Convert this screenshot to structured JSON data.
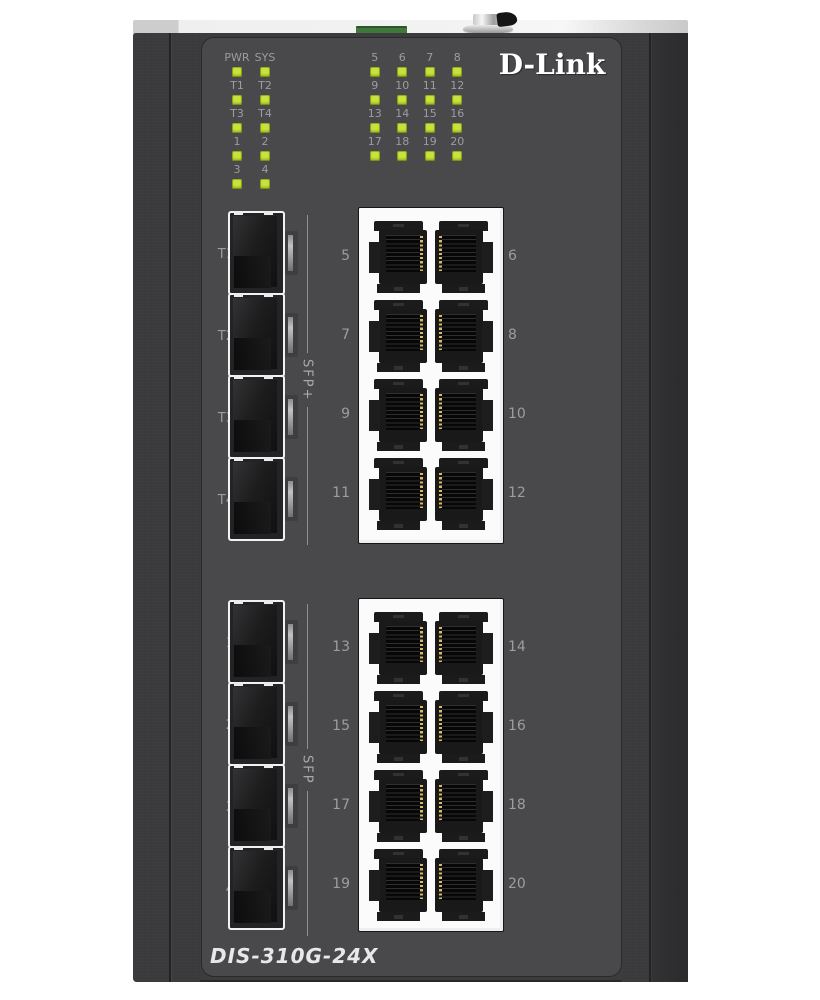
{
  "device": {
    "brand": "D-Link",
    "model": "DIS-310G-24X",
    "led_color": "#c8e23a",
    "body_color": "#49494b"
  },
  "leds": {
    "left": {
      "rows": [
        [
          "PWR",
          "SYS"
        ],
        [
          "T1",
          "T2"
        ],
        [
          "T3",
          "T4"
        ],
        [
          "1",
          "2"
        ],
        [
          "3",
          "4"
        ]
      ]
    },
    "right": {
      "rows": [
        [
          "5",
          "6",
          "7",
          "8"
        ],
        [
          "9",
          "10",
          "11",
          "12"
        ],
        [
          "13",
          "14",
          "15",
          "16"
        ],
        [
          "17",
          "18",
          "19",
          "20"
        ]
      ]
    }
  },
  "upper": {
    "sfp": {
      "labels": [
        "T1",
        "T2",
        "T3",
        "T4"
      ],
      "group": "SFP+"
    },
    "rj45": {
      "left": [
        "5",
        "7",
        "9",
        "11"
      ],
      "right": [
        "6",
        "8",
        "10",
        "12"
      ]
    }
  },
  "lower": {
    "sfp": {
      "labels": [
        "1",
        "2",
        "3",
        "4"
      ],
      "group": "SFP"
    },
    "rj45": {
      "left": [
        "13",
        "15",
        "17",
        "19"
      ],
      "right": [
        "14",
        "16",
        "18",
        "20"
      ]
    }
  }
}
